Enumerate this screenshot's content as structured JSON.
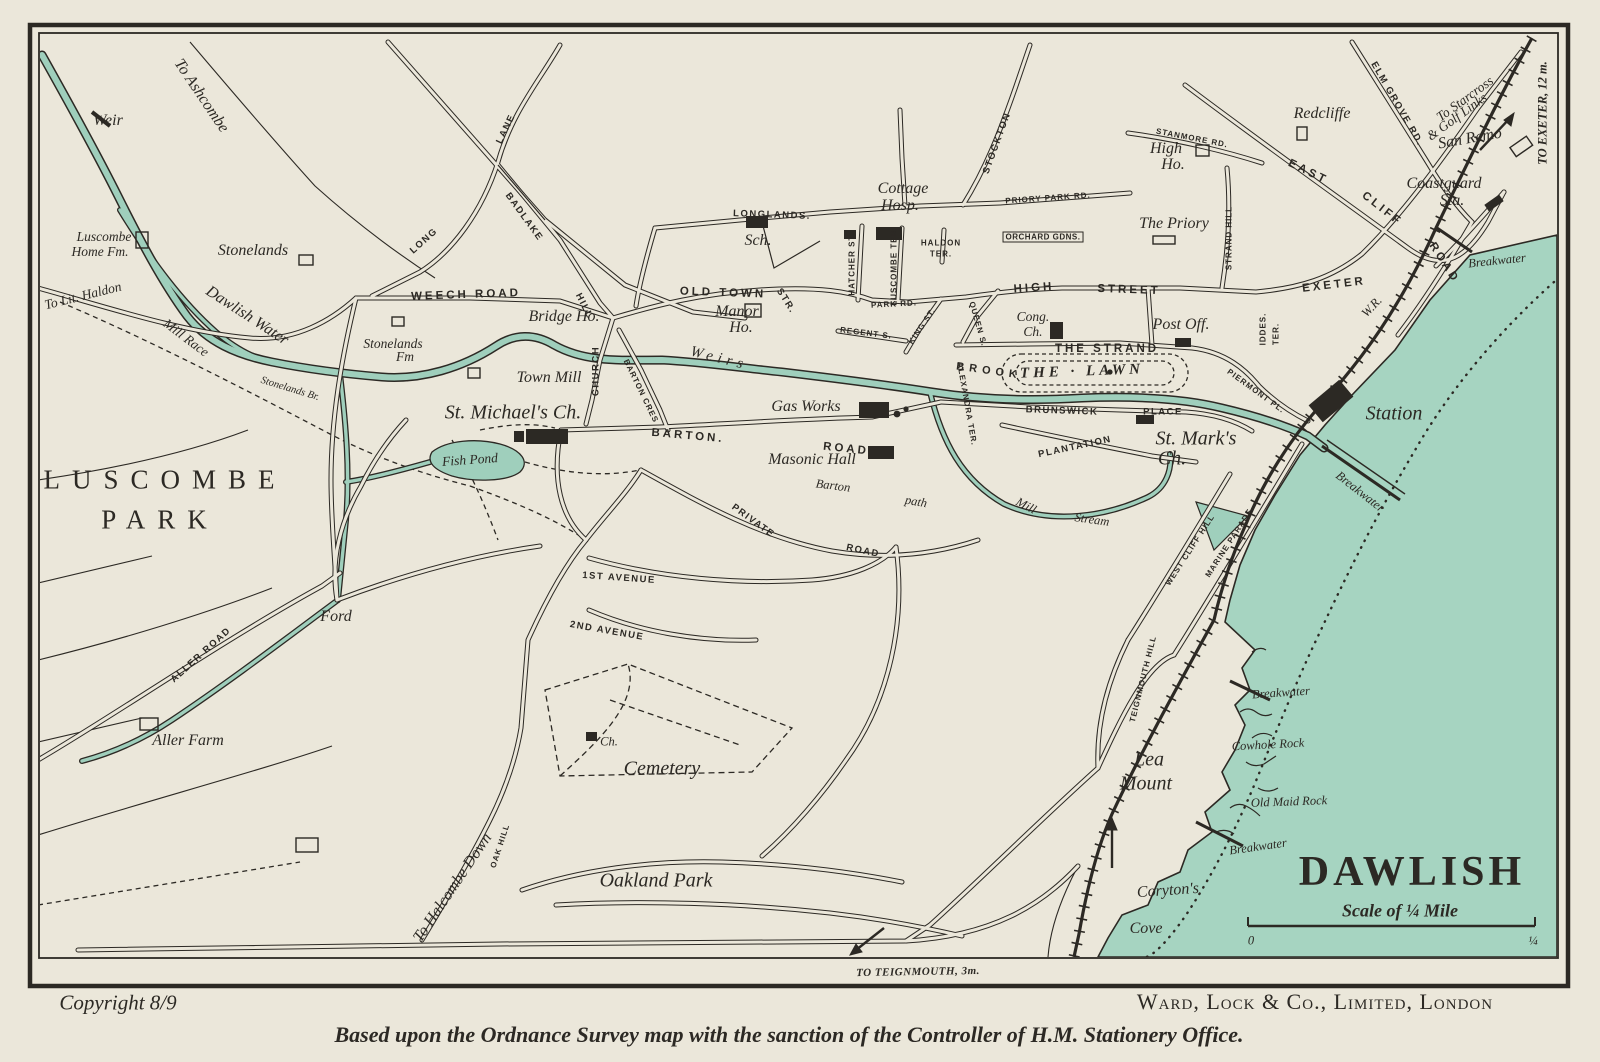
{
  "map": {
    "title": "DAWLISH",
    "scale_caption": "Scale of ¼ Mile",
    "scale_start": "0",
    "scale_end": "¼"
  },
  "credits": {
    "copyright": "Copyright 8/9",
    "publisher": "Ward, Lock & Co., Limited, London",
    "attribution": "Based upon the Ordnance Survey map with the sanction of the Controller of H.M. Stationery Office."
  },
  "colors": {
    "paper": "#ebe7da",
    "sea": "#a6d4c1",
    "water": "#9fcfbc",
    "ink": "#2c2924"
  },
  "labels": [
    {
      "t": "To Ashcombe",
      "x": 201,
      "y": 96,
      "r": 56,
      "c": "pl"
    },
    {
      "t": "Weir",
      "x": 108,
      "y": 121,
      "r": 0,
      "c": "pl"
    },
    {
      "t": "Luscombe",
      "x": 104,
      "y": 237,
      "r": 0,
      "c": "pls2"
    },
    {
      "t": "Home Fm.",
      "x": 100,
      "y": 252,
      "r": 0,
      "c": "pls2"
    },
    {
      "t": "Stonelands",
      "x": 253,
      "y": 251,
      "r": 0,
      "c": "pl"
    },
    {
      "t": "To Lit. Haldon",
      "x": 83,
      "y": 296,
      "r": -14,
      "c": "pls2"
    },
    {
      "t": "Mill Race",
      "x": 186,
      "y": 338,
      "r": 37,
      "c": "pls2"
    },
    {
      "t": "Dawlish Water",
      "x": 247,
      "y": 316,
      "r": 33,
      "c": "pl"
    },
    {
      "t": "Stonelands Br.",
      "x": 290,
      "y": 389,
      "r": 17,
      "c": "pls3"
    },
    {
      "t": "LONG",
      "x": 424,
      "y": 241,
      "r": -42,
      "c": "rds"
    },
    {
      "t": "LANE",
      "x": 506,
      "y": 129,
      "r": -64,
      "c": "rds"
    },
    {
      "t": "BADLAKE",
      "x": 524,
      "y": 217,
      "r": 54,
      "c": "rds"
    },
    {
      "t": "HILL",
      "x": 584,
      "y": 306,
      "r": 63,
      "c": "rds"
    },
    {
      "t": "WEECH ROAD",
      "x": 466,
      "y": 295,
      "r": -2,
      "c": "rd"
    },
    {
      "t": "Stonelands",
      "x": 393,
      "y": 344,
      "r": 0,
      "c": "pls2"
    },
    {
      "t": "Fm",
      "x": 405,
      "y": 357,
      "r": 0,
      "c": "pls2"
    },
    {
      "t": "LUSCOMBE",
      "x": 165,
      "y": 480,
      "r": 0,
      "c": "park"
    },
    {
      "t": "PARK",
      "x": 160,
      "y": 520,
      "r": 0,
      "c": "park"
    },
    {
      "t": "Fish Pond",
      "x": 470,
      "y": 460,
      "r": -4,
      "c": "pls2"
    },
    {
      "t": "Bridge Ho.",
      "x": 564,
      "y": 317,
      "r": 0,
      "c": "pl"
    },
    {
      "t": "Town Mill",
      "x": 549,
      "y": 378,
      "r": 0,
      "c": "pl"
    },
    {
      "t": "St. Michael's Ch.",
      "x": 513,
      "y": 413,
      "r": 0,
      "c": "plb"
    },
    {
      "t": "CHURCH",
      "x": 596,
      "y": 371,
      "r": -90,
      "c": "rds"
    },
    {
      "t": "BARTON CRES",
      "x": 641,
      "y": 391,
      "r": 64,
      "c": "rds3"
    },
    {
      "t": "OLD TOWN",
      "x": 723,
      "y": 293,
      "r": 2,
      "c": "rd"
    },
    {
      "t": "STR.",
      "x": 786,
      "y": 301,
      "r": 58,
      "c": "rds"
    },
    {
      "t": "Manor",
      "x": 737,
      "y": 312,
      "r": 0,
      "c": "pl"
    },
    {
      "t": "Ho.",
      "x": 741,
      "y": 328,
      "r": 0,
      "c": "pl"
    },
    {
      "t": "LONGLANDS.",
      "x": 772,
      "y": 215,
      "r": 2,
      "c": "rds"
    },
    {
      "t": "Sch.",
      "x": 758,
      "y": 241,
      "r": 0,
      "c": "pl"
    },
    {
      "t": "Cottage",
      "x": 903,
      "y": 189,
      "r": 0,
      "c": "pl"
    },
    {
      "t": "Hosp.",
      "x": 900,
      "y": 206,
      "r": 0,
      "c": "pl"
    },
    {
      "t": "STOCKTON",
      "x": 997,
      "y": 143,
      "r": -70,
      "c": "rds"
    },
    {
      "t": "PRIORY PARK RD.",
      "x": 1048,
      "y": 198,
      "r": -4,
      "c": "rds3"
    },
    {
      "t": "HATCHER ST.",
      "x": 852,
      "y": 264,
      "r": -90,
      "c": "rds3"
    },
    {
      "t": "LUSCOMBE TER.",
      "x": 894,
      "y": 266,
      "r": -90,
      "c": "rds3"
    },
    {
      "t": "HALDON",
      "x": 941,
      "y": 243,
      "r": 0,
      "c": "rds3"
    },
    {
      "t": "TER.",
      "x": 941,
      "y": 254,
      "r": 0,
      "c": "rds3"
    },
    {
      "t": "ORCHARD GDNS.",
      "x": 1043,
      "y": 237,
      "r": 0,
      "c": "box"
    },
    {
      "t": "HIGH",
      "x": 1034,
      "y": 288,
      "r": -4,
      "c": "rd"
    },
    {
      "t": "STREET",
      "x": 1129,
      "y": 290,
      "r": 2,
      "c": "rd"
    },
    {
      "t": "QUEEN S.",
      "x": 978,
      "y": 324,
      "r": 74,
      "c": "rds3"
    },
    {
      "t": "KING ST.",
      "x": 922,
      "y": 326,
      "r": -56,
      "c": "rds3"
    },
    {
      "t": "REGENT S.",
      "x": 866,
      "y": 333,
      "r": 7,
      "c": "rds3"
    },
    {
      "t": "PARK RD.",
      "x": 894,
      "y": 304,
      "r": -3,
      "c": "rds3"
    },
    {
      "t": "Cong.",
      "x": 1033,
      "y": 317,
      "r": 0,
      "c": "pls2"
    },
    {
      "t": "Ch.",
      "x": 1033,
      "y": 332,
      "r": 0,
      "c": "pls2"
    },
    {
      "t": "THE STRAND",
      "x": 1107,
      "y": 349,
      "r": 0,
      "c": "rd"
    },
    {
      "t": "Post Off.",
      "x": 1181,
      "y": 325,
      "r": 0,
      "c": "pl"
    },
    {
      "t": "THE · LAWN",
      "x": 1082,
      "y": 372,
      "r": -2,
      "c": "lawn"
    },
    {
      "t": "EXETER",
      "x": 1334,
      "y": 285,
      "r": -7,
      "c": "rd"
    },
    {
      "t": "EAST",
      "x": 1308,
      "y": 172,
      "r": 26,
      "c": "rd"
    },
    {
      "t": "CLIFF",
      "x": 1382,
      "y": 209,
      "r": 38,
      "c": "rd"
    },
    {
      "t": "ROAD",
      "x": 1444,
      "y": 263,
      "r": 57,
      "c": "rd"
    },
    {
      "t": "STANMORE RD.",
      "x": 1192,
      "y": 138,
      "r": 11,
      "c": "rds3"
    },
    {
      "t": "High",
      "x": 1166,
      "y": 149,
      "r": 0,
      "c": "pl"
    },
    {
      "t": "Ho.",
      "x": 1173,
      "y": 165,
      "r": 0,
      "c": "pl"
    },
    {
      "t": "Redcliffe",
      "x": 1322,
      "y": 114,
      "r": 0,
      "c": "pl"
    },
    {
      "t": "The Priory",
      "x": 1174,
      "y": 224,
      "r": 0,
      "c": "pl"
    },
    {
      "t": "STRAND HILL",
      "x": 1229,
      "y": 238,
      "r": -90,
      "c": "rds3"
    },
    {
      "t": "ELM GROVE RD.",
      "x": 1397,
      "y": 104,
      "r": 60,
      "c": "rds"
    },
    {
      "t": "San Remo",
      "x": 1470,
      "y": 139,
      "r": -10,
      "c": "pl"
    },
    {
      "t": "To Starcross",
      "x": 1465,
      "y": 99,
      "r": -36,
      "c": "pls2"
    },
    {
      "t": "& Golf Links",
      "x": 1457,
      "y": 117,
      "r": -36,
      "c": "pls2"
    },
    {
      "t": "TO EXETER, 12 m.",
      "x": 1543,
      "y": 113,
      "r": -90,
      "c": "pli"
    },
    {
      "t": "Coastguard",
      "x": 1444,
      "y": 184,
      "r": 0,
      "c": "pl"
    },
    {
      "t": "Sta.",
      "x": 1452,
      "y": 201,
      "r": 0,
      "c": "pl"
    },
    {
      "t": "Breakwater",
      "x": 1497,
      "y": 261,
      "r": -6,
      "c": "pls"
    },
    {
      "t": "IDDES.",
      "x": 1263,
      "y": 329,
      "r": -90,
      "c": "rds3"
    },
    {
      "t": "TER.",
      "x": 1276,
      "y": 334,
      "r": -90,
      "c": "rds3"
    },
    {
      "t": "PIERMONT PL.",
      "x": 1256,
      "y": 391,
      "r": 36,
      "c": "rds3"
    },
    {
      "t": "BRUNSWICK",
      "x": 1062,
      "y": 411,
      "r": 2,
      "c": "rds"
    },
    {
      "t": "PLACE",
      "x": 1163,
      "y": 412,
      "r": 0,
      "c": "rds"
    },
    {
      "t": "ALEXANDRA TER.",
      "x": 967,
      "y": 404,
      "r": 80,
      "c": "rds3"
    },
    {
      "t": "PLANTATION",
      "x": 1075,
      "y": 447,
      "r": -12,
      "c": "rds"
    },
    {
      "t": "St. Mark's",
      "x": 1196,
      "y": 439,
      "r": 0,
      "c": "plb"
    },
    {
      "t": "Ch.",
      "x": 1172,
      "y": 459,
      "r": 0,
      "c": "plb"
    },
    {
      "t": "Gas Works",
      "x": 806,
      "y": 407,
      "r": 0,
      "c": "pl"
    },
    {
      "t": "BARTON.",
      "x": 688,
      "y": 436,
      "r": 5,
      "c": "rd"
    },
    {
      "t": "ROAD",
      "x": 846,
      "y": 449,
      "r": 6,
      "c": "rd"
    },
    {
      "t": "Masonic Hall",
      "x": 812,
      "y": 460,
      "r": 0,
      "c": "pl"
    },
    {
      "t": "Barton",
      "x": 833,
      "y": 486,
      "r": 7,
      "c": "pls"
    },
    {
      "t": "path",
      "x": 916,
      "y": 502,
      "r": 10,
      "c": "pls"
    },
    {
      "t": "Mill",
      "x": 1026,
      "y": 506,
      "r": 28,
      "c": "pls"
    },
    {
      "t": "Stream",
      "x": 1092,
      "y": 520,
      "r": 8,
      "c": "pls"
    },
    {
      "t": "PRIVATE",
      "x": 753,
      "y": 521,
      "r": 36,
      "c": "rds"
    },
    {
      "t": "ROAD",
      "x": 863,
      "y": 551,
      "r": 12,
      "c": "rds"
    },
    {
      "t": "W.R.",
      "x": 1372,
      "y": 307,
      "r": -47,
      "c": "pls"
    },
    {
      "t": "Station",
      "x": 1394,
      "y": 414,
      "r": 0,
      "c": "plb"
    },
    {
      "t": "Breakwater",
      "x": 1360,
      "y": 492,
      "r": 38,
      "c": "pls"
    },
    {
      "t": "WEST CLIFF HILL",
      "x": 1190,
      "y": 550,
      "r": -57,
      "c": "rds3"
    },
    {
      "t": "MARINE PARADE",
      "x": 1229,
      "y": 543,
      "r": -57,
      "c": "rds3"
    },
    {
      "t": "TEIGNMOUTH HILL",
      "x": 1143,
      "y": 679,
      "r": -76,
      "c": "rds3"
    },
    {
      "t": "Lea",
      "x": 1149,
      "y": 760,
      "r": 0,
      "c": "plb"
    },
    {
      "t": "Mount",
      "x": 1146,
      "y": 784,
      "r": 0,
      "c": "plb"
    },
    {
      "t": "Breakwater",
      "x": 1281,
      "y": 693,
      "r": -4,
      "c": "pls"
    },
    {
      "t": "Cowhole Rock",
      "x": 1268,
      "y": 745,
      "r": -3,
      "c": "pls"
    },
    {
      "t": "Old Maid Rock",
      "x": 1289,
      "y": 802,
      "r": -2,
      "c": "pls"
    },
    {
      "t": "Breakwater",
      "x": 1258,
      "y": 847,
      "r": -8,
      "c": "pls"
    },
    {
      "t": "Coryton's",
      "x": 1168,
      "y": 891,
      "r": -4,
      "c": "pl"
    },
    {
      "t": "Cove",
      "x": 1146,
      "y": 929,
      "r": 0,
      "c": "pl"
    },
    {
      "t": "1ST AVENUE",
      "x": 619,
      "y": 578,
      "r": 4,
      "c": "rds"
    },
    {
      "t": "2ND AVENUE",
      "x": 607,
      "y": 631,
      "r": 10,
      "c": "rds"
    },
    {
      "t": "Cemetery",
      "x": 662,
      "y": 769,
      "r": 0,
      "c": "plb"
    },
    {
      "t": "Ch.",
      "x": 609,
      "y": 742,
      "r": 0,
      "c": "pls"
    },
    {
      "t": "Oakland Park",
      "x": 656,
      "y": 881,
      "r": 0,
      "c": "plb"
    },
    {
      "t": "To Halcombe Down",
      "x": 453,
      "y": 888,
      "r": -56,
      "c": "pl"
    },
    {
      "t": "OAK HILL",
      "x": 500,
      "y": 846,
      "r": -72,
      "c": "rds3"
    },
    {
      "t": "ALLER ROAD",
      "x": 201,
      "y": 655,
      "r": -42,
      "c": "rds"
    },
    {
      "t": "Ford",
      "x": 336,
      "y": 617,
      "r": 0,
      "c": "pl"
    },
    {
      "t": "Aller Farm",
      "x": 188,
      "y": 741,
      "r": 0,
      "c": "pl"
    },
    {
      "t": "Weirs",
      "x": 719,
      "y": 359,
      "r": 14,
      "c": "plw"
    },
    {
      "t": "BROOK",
      "x": 989,
      "y": 371,
      "r": 8,
      "c": "rdw"
    },
    {
      "t": "TO TEIGNMOUTH, 3m.",
      "x": 918,
      "y": 972,
      "r": -1,
      "c": "pli3"
    }
  ]
}
